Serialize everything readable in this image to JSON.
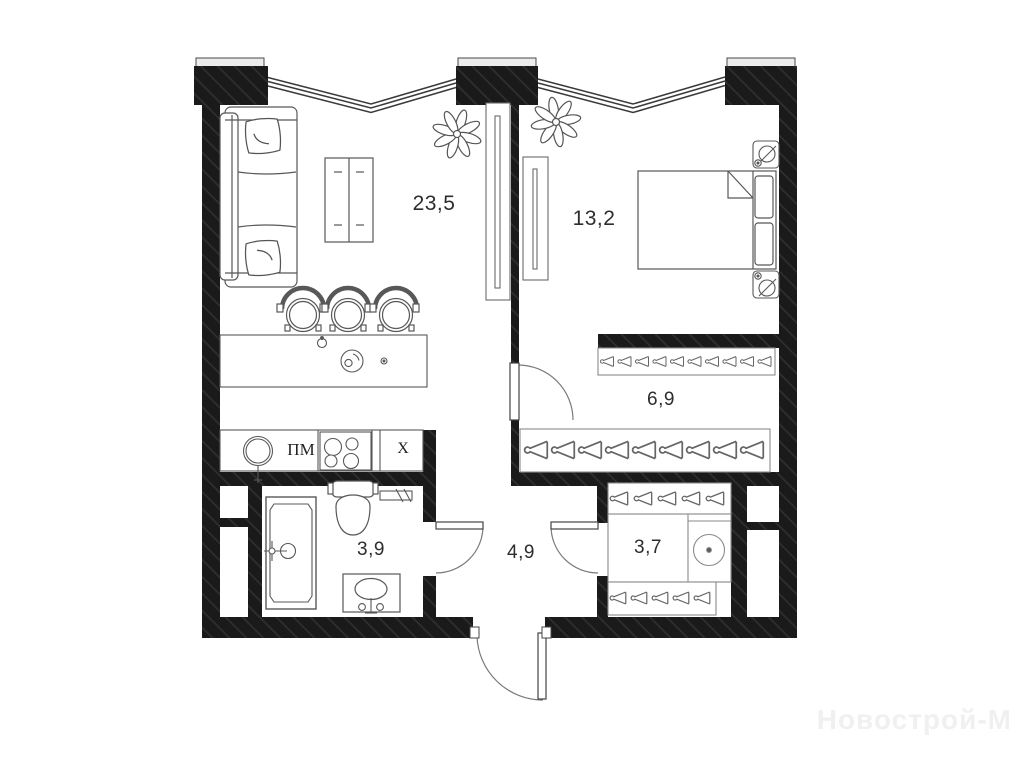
{
  "rooms": {
    "living_kitchen": "23,5",
    "bedroom": "13,2",
    "wardrobe": "6,9",
    "bathroom": "3,9",
    "hallway": "4,9",
    "storage": "3,7"
  },
  "appliances": {
    "dishwasher": "ПМ",
    "fridge": "X"
  },
  "watermark": "Новострой-М",
  "icons": {
    "hanger": "hanger-icon",
    "plant": "plant-icon",
    "lamp": "lamp-icon",
    "washing_machine": "washing-machine-icon"
  },
  "colors": {
    "wall": "#1a1a1a",
    "wall_hatch": "#2f2f2f",
    "furniture_line": "#585858",
    "pillar_cap": "#ececec",
    "label": "#2d2d2d",
    "watermark": "#f0f0f0"
  }
}
